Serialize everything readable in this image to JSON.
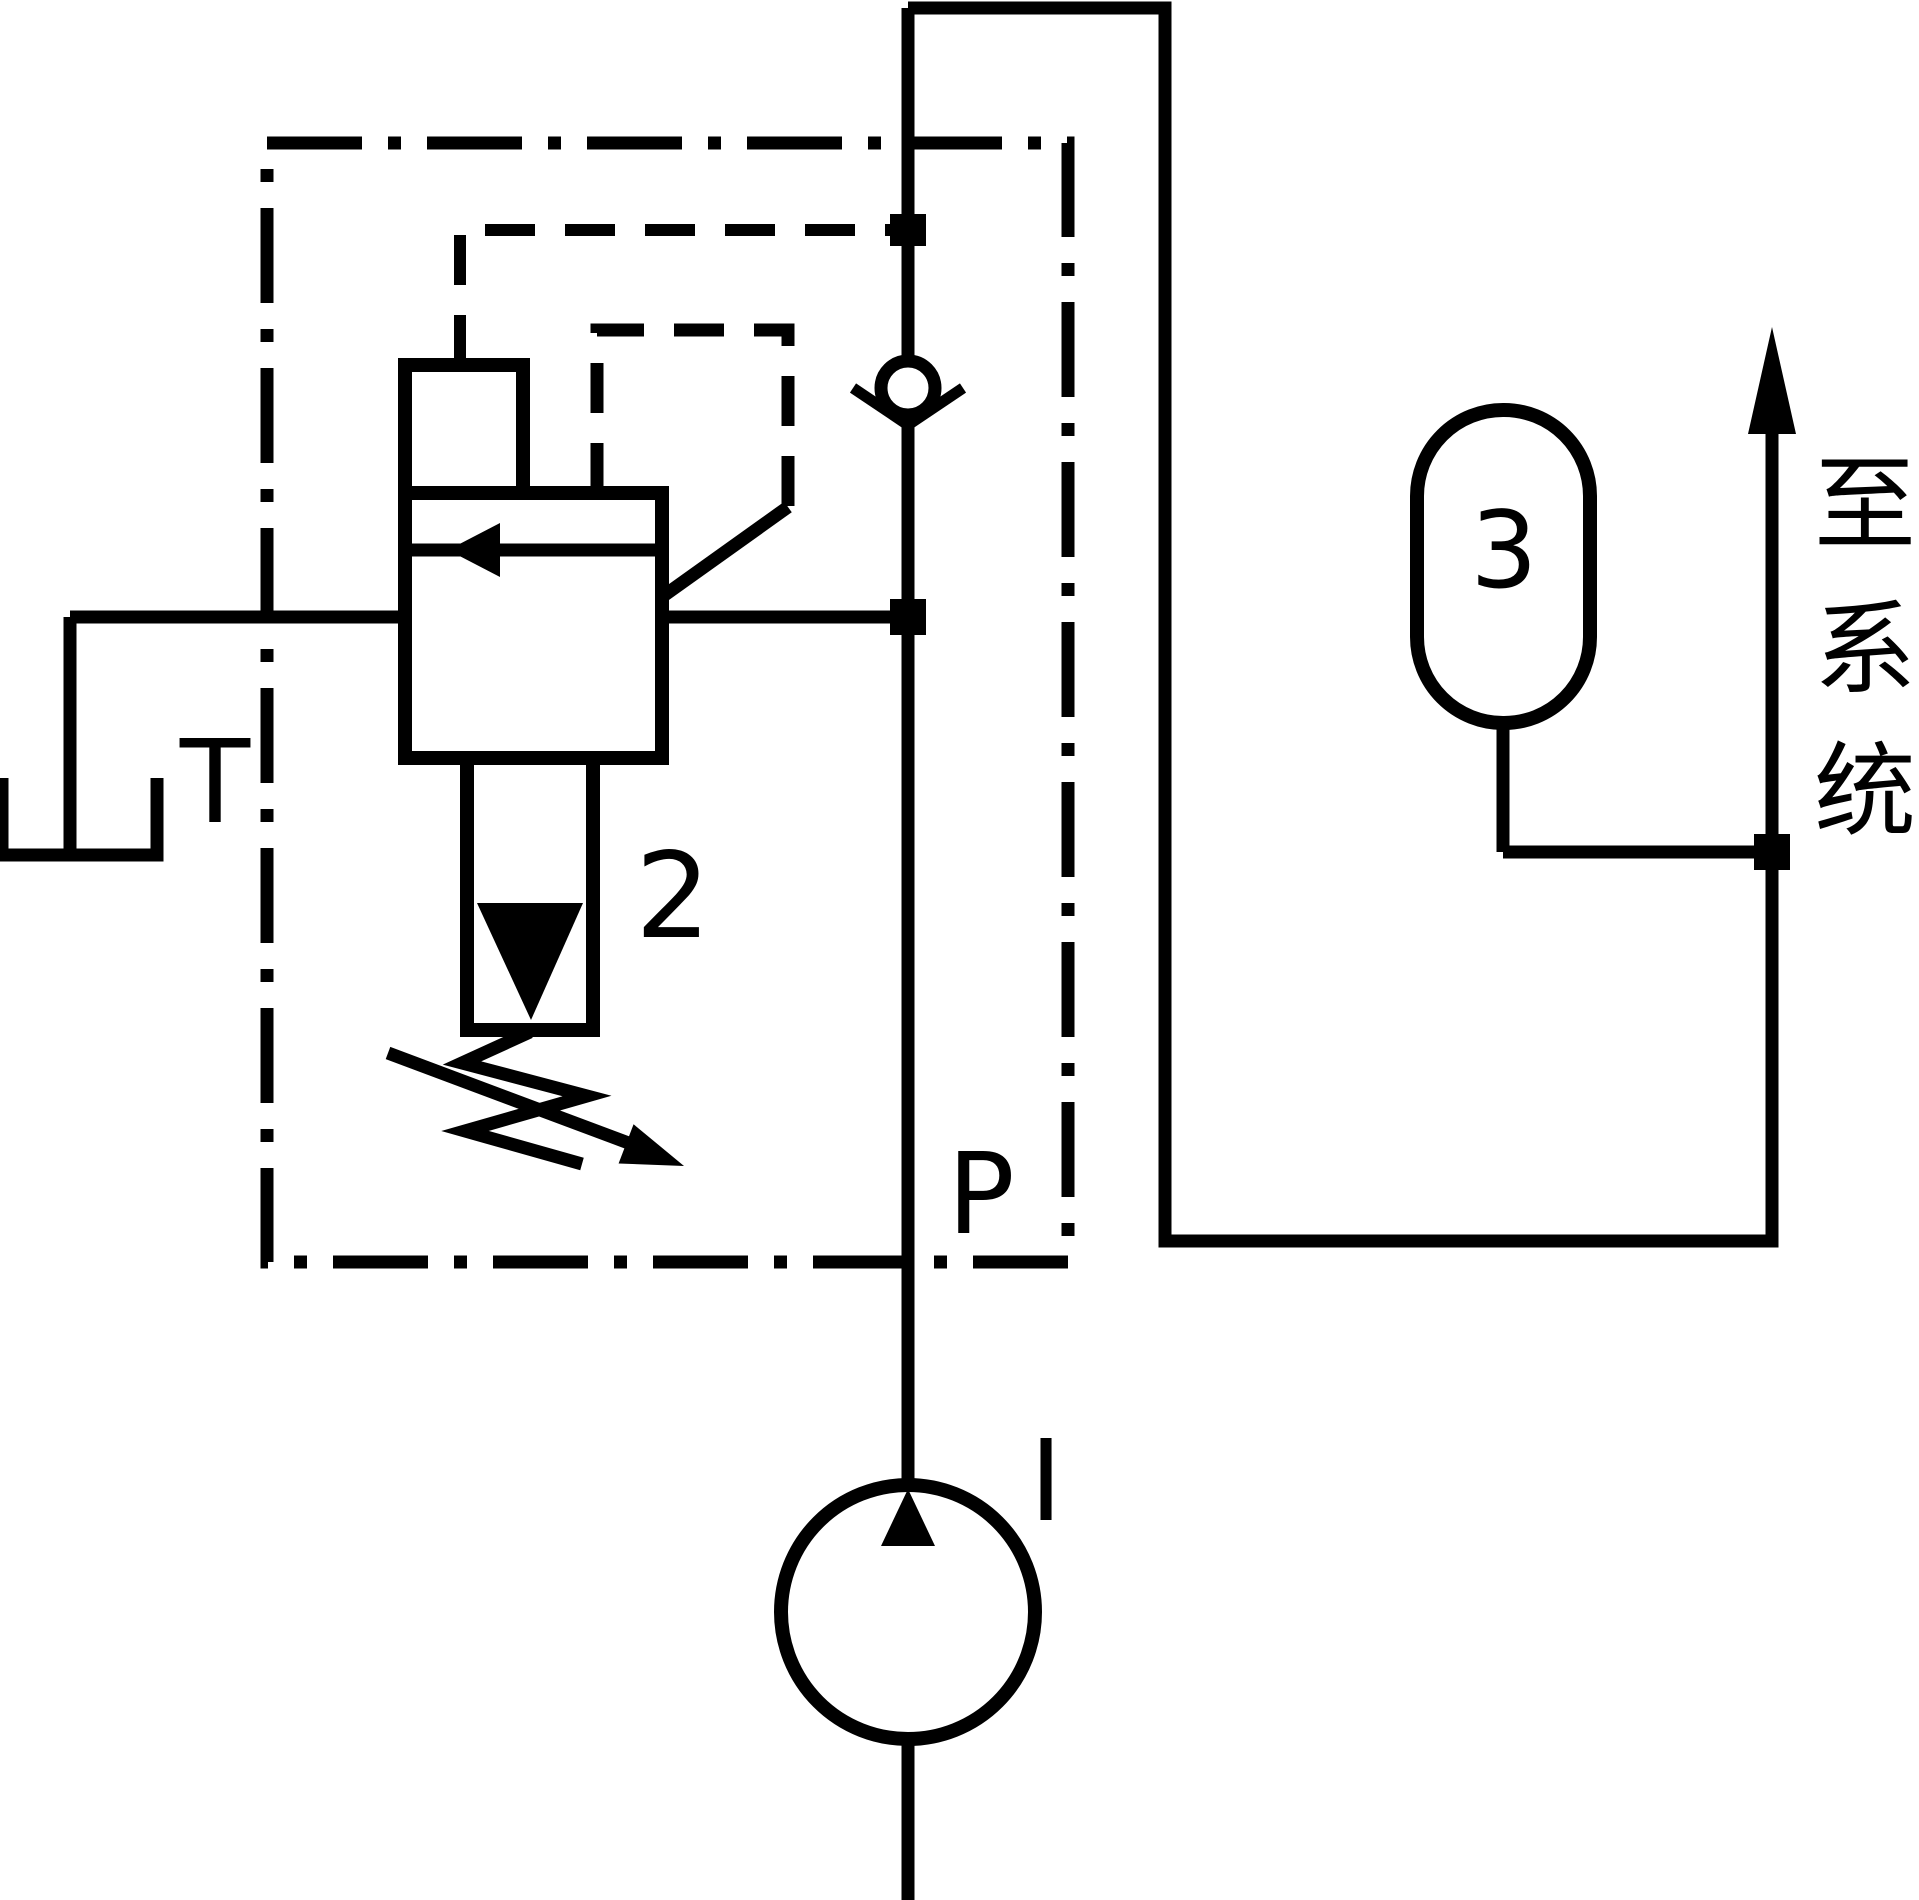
{
  "diagram": {
    "type": "hydraulic-circuit-schematic",
    "background_color": "#ffffff",
    "line_color": "#000000",
    "labels": {
      "tank_port": "T",
      "pressure_port": "P",
      "pump": "I",
      "relief_valve": "2",
      "accumulator": "3"
    },
    "annotation": {
      "text": "至系统",
      "chars": [
        "至",
        "系",
        "统"
      ]
    }
  }
}
